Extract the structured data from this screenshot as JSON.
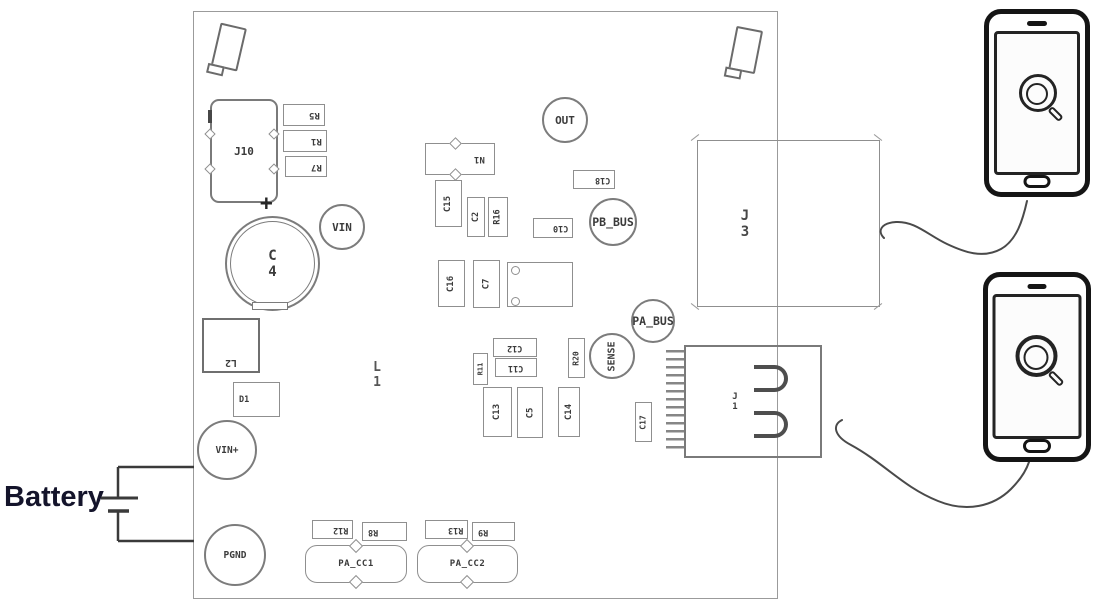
{
  "colors": {
    "line": "#8f8f8f",
    "silkscreen_text": "#3b3b3b",
    "phone": "#151515",
    "wire": "#4a4a4a",
    "battery_text": "#14142b"
  },
  "battery": {
    "label": "Battery"
  },
  "board": {
    "silkscreen": {
      "j10": "J10",
      "r5": "R5",
      "r1": "R1",
      "r7": "R7",
      "plus": "+",
      "c4": "C4",
      "vin": "VIN",
      "l2": "L2",
      "d1": "D1",
      "vin_plus": "VIN+",
      "pgnd": "PGND",
      "n1": "N1",
      "c15": "C15",
      "c2": "C2",
      "r16": "R16",
      "out": "OUT",
      "c18": "C18",
      "c10": "C10",
      "pb_bus": "PB_BUS",
      "c16": "C16",
      "c7": "C7",
      "pa_bus": "PA_BUS",
      "sense": "SENSE",
      "r20": "R20",
      "c12": "C12",
      "c11": "C11",
      "r11": "R11",
      "c13": "C13",
      "c5": "C5",
      "c14": "C14",
      "c17": "C17",
      "l1": "L1",
      "j1": "J1",
      "j3": "J3",
      "r12": "R12",
      "r8": "R8",
      "r13": "R13",
      "r9": "R9",
      "pa_cc1": "PA_CC1",
      "pa_cc2": "PA_CC2"
    }
  },
  "phones": {
    "screen_icon": "magnifier"
  }
}
